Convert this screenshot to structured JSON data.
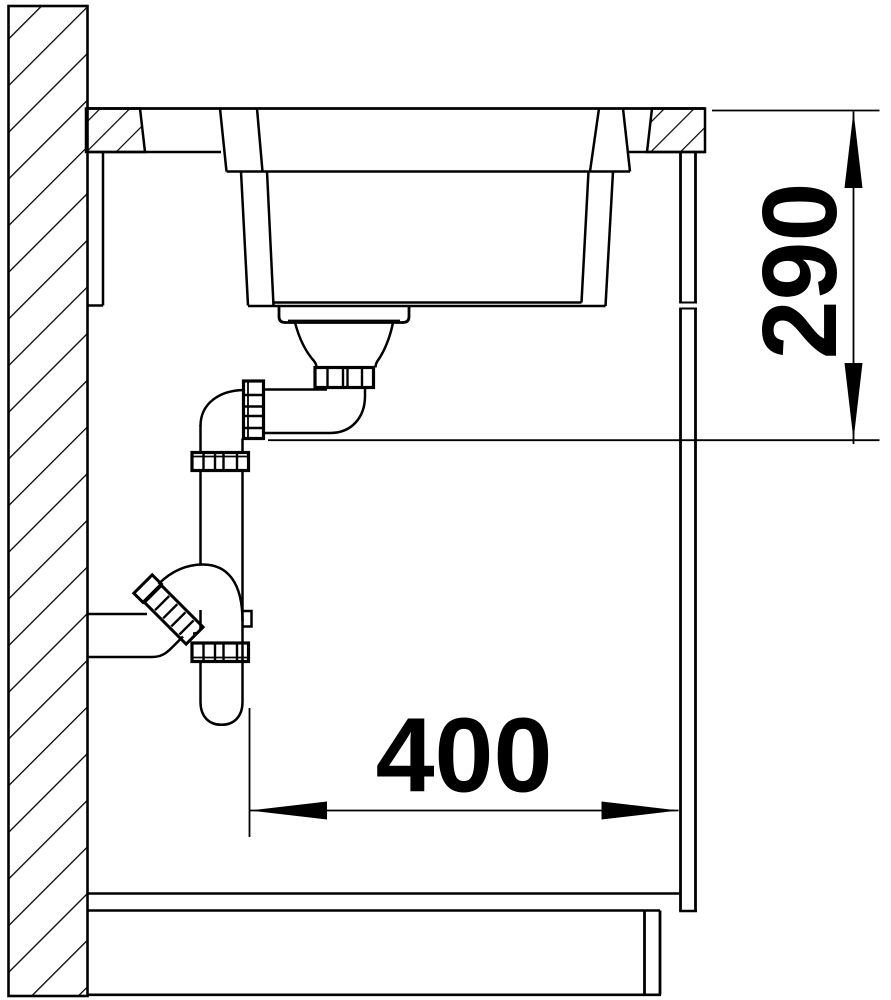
{
  "page": {
    "background": "#ffffff",
    "line_color": "#000000"
  },
  "drawing": {
    "kind": "sink installation side cross-section",
    "units": "mm",
    "components": [
      "wall-section-hatched",
      "countertop",
      "undermount-sink-basin",
      "basket-strainer",
      "drain-tailpipe-elbow",
      "union-nuts",
      "space-saving-trap-siphon",
      "wall-outlet-pipe",
      "cabinet-side-panel",
      "cabinet-bottom-shelf",
      "plinth"
    ],
    "dimensions": {
      "drain_height": {
        "value": "290",
        "orientation": "vertical"
      },
      "trap_clearance": {
        "value": "400",
        "orientation": "horizontal"
      }
    }
  }
}
